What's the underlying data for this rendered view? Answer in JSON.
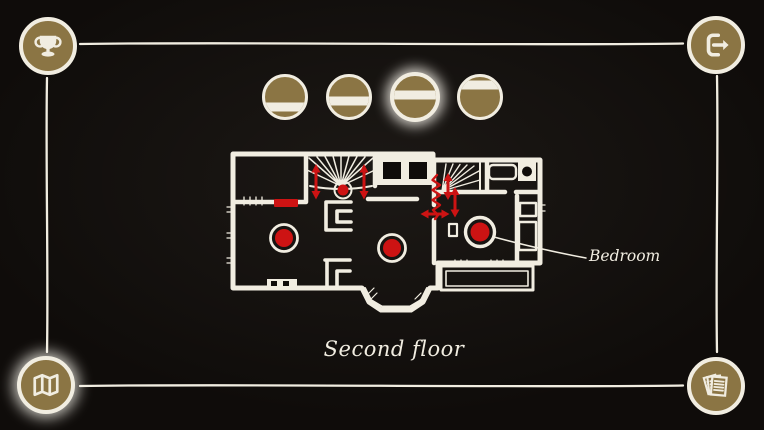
{
  "colors": {
    "background": "#0f0c0a",
    "chalk": "#f1ede1",
    "gold": "#8b7544",
    "red": "#cd1313"
  },
  "nav": {
    "achievements_button": {
      "icon": "trophy-icon",
      "selected": false
    },
    "exit_button": {
      "icon": "exit-icon",
      "selected": false
    },
    "map_button": {
      "icon": "map-icon",
      "selected": true
    },
    "journal_button": {
      "icon": "cards-icon",
      "selected": false
    }
  },
  "floor_selector": {
    "buttons": [
      {
        "band_position": 0.74,
        "selected": false
      },
      {
        "band_position": 0.61,
        "selected": false
      },
      {
        "band_position": 0.45,
        "selected": true
      },
      {
        "band_position": 0.2,
        "selected": false
      }
    ]
  },
  "map": {
    "floor_label": "Second floor",
    "annotation_label": "Bedroom",
    "markers": {
      "room_dots": 3,
      "stair_dot": 1,
      "red_door_bar": 1,
      "vertical_arrows": 4,
      "horizontal_arrows": 1,
      "squiggle_marks": 1
    }
  }
}
